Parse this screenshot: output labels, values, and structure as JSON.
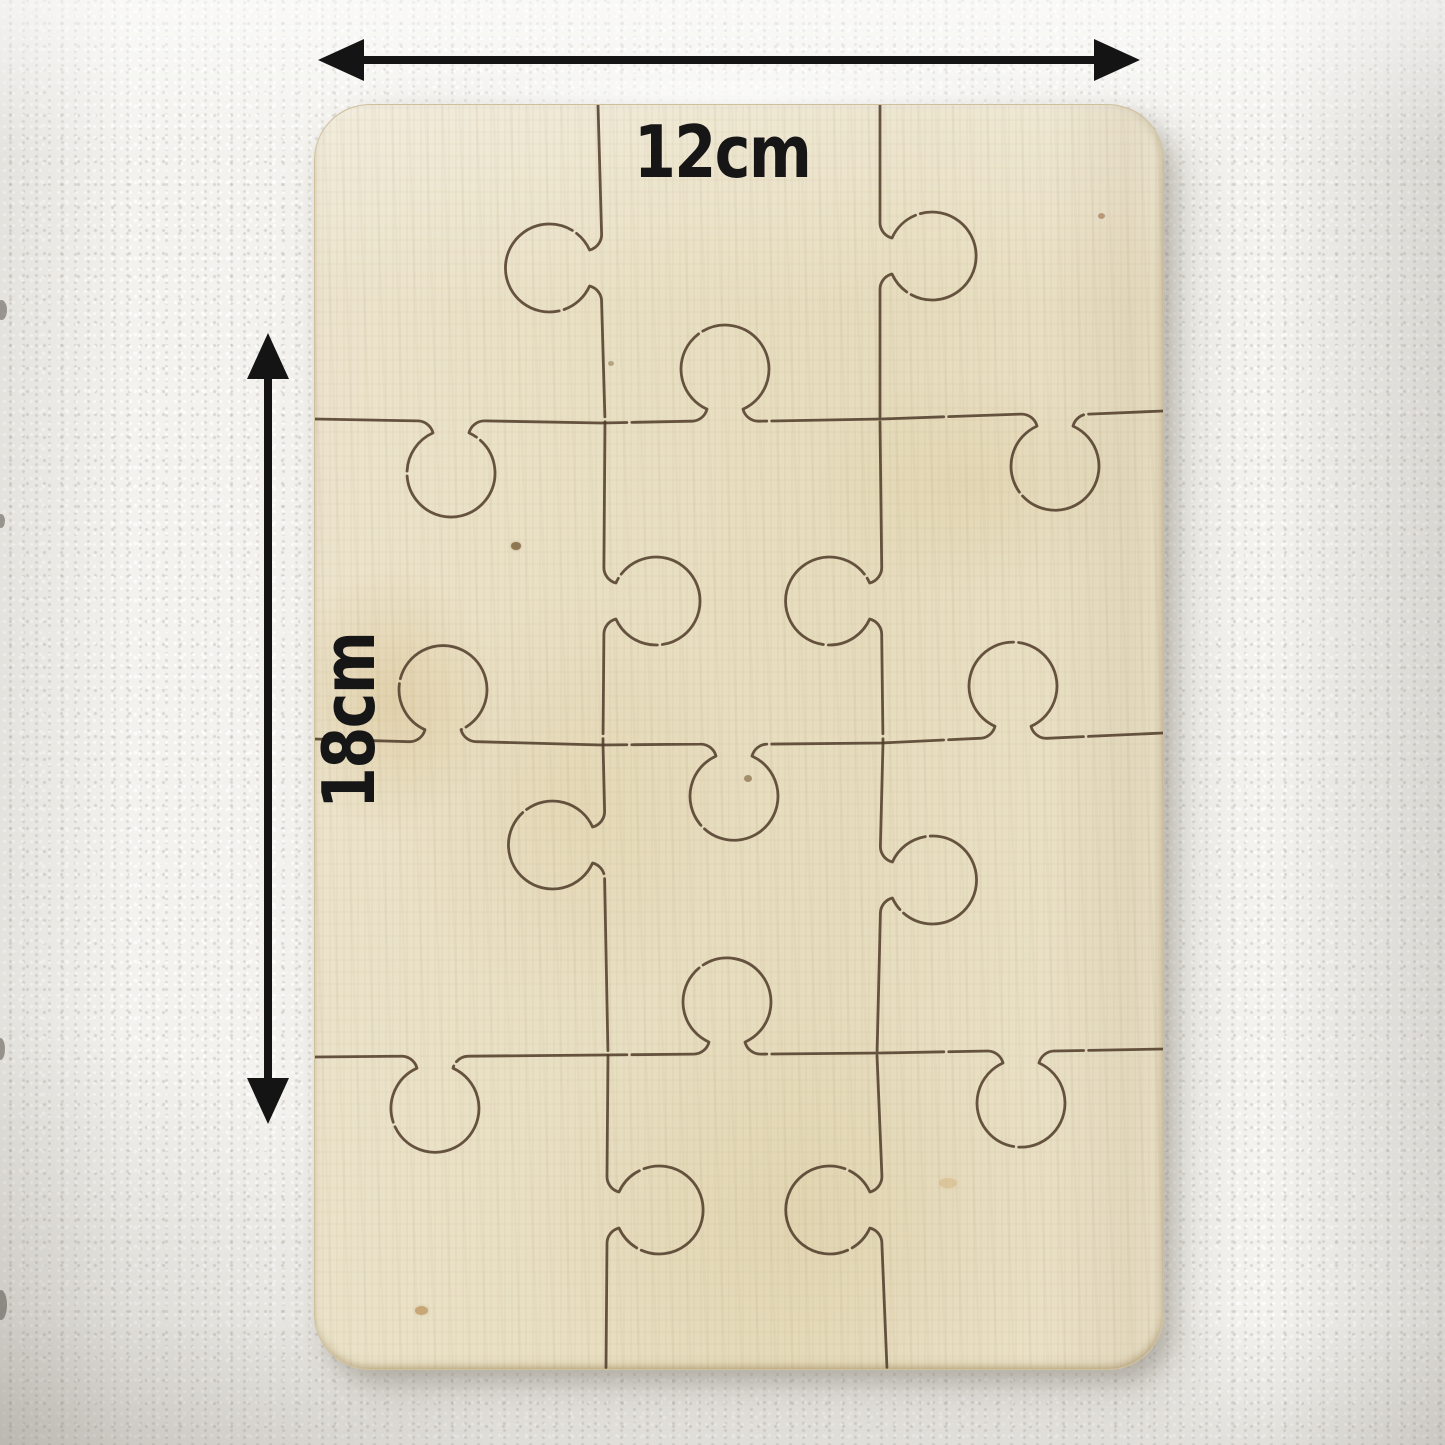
{
  "dimension_labels": {
    "width": "12cm",
    "height": "18cm"
  },
  "colors": {
    "ink": "#141414",
    "wall": "#f3f2ee",
    "wood": "#e8dfc3",
    "wood_highlight": "#efe8d4",
    "wood_warm": "#e0d1a8",
    "wood_edge": "#cfc09c",
    "cut_line": "#4d3a28",
    "shadow": "#8d8779"
  },
  "puzzle": {
    "type": "blank-wooden-jigsaw",
    "rows": 4,
    "cols": 3,
    "pieces": 12,
    "view_w": 848,
    "view_h": 1264,
    "h_breaks": [
      0,
      286,
      566,
      848
    ],
    "v_breaks": [
      0,
      316,
      638,
      950,
      1264
    ],
    "h_cuts": [
      {
        "y": [
          314,
          318,
          314,
          306
        ],
        "knobs": [
          {
            "c": 136,
            "s": 1
          },
          {
            "c": 410,
            "s": -1
          },
          {
            "c": 740,
            "s": 1
          }
        ]
      },
      {
        "y": [
          634,
          640,
          638,
          628
        ],
        "knobs": [
          {
            "c": 128,
            "s": -1
          },
          {
            "c": 419,
            "s": 1
          },
          {
            "c": 698,
            "s": -1
          }
        ]
      },
      {
        "y": [
          952,
          950,
          948,
          944
        ],
        "knobs": [
          {
            "c": 120,
            "s": 1
          },
          {
            "c": 412,
            "s": -1
          },
          {
            "c": 706,
            "s": 1
          }
        ]
      }
    ],
    "v_cuts": [
      {
        "x": [
          283,
          290,
          288,
          293,
          291
        ],
        "knobs": [
          {
            "c": 163,
            "s": -1
          },
          {
            "c": 496,
            "s": 1
          },
          {
            "c": 740,
            "s": -1
          },
          {
            "c": 1105,
            "s": 1
          }
        ]
      },
      {
        "x": [
          565,
          565,
          568,
          562,
          572
        ],
        "knobs": [
          {
            "c": 151,
            "s": 1
          },
          {
            "c": 496,
            "s": -1
          },
          {
            "c": 775,
            "s": 1
          },
          {
            "c": 1105,
            "s": -1
          }
        ]
      }
    ],
    "knob_shape": {
      "neck_half": 34,
      "small_r": 16,
      "inner_half": 18,
      "depth": 12,
      "bulb_r": 44
    },
    "cut_stroke_width": 2.8
  }
}
